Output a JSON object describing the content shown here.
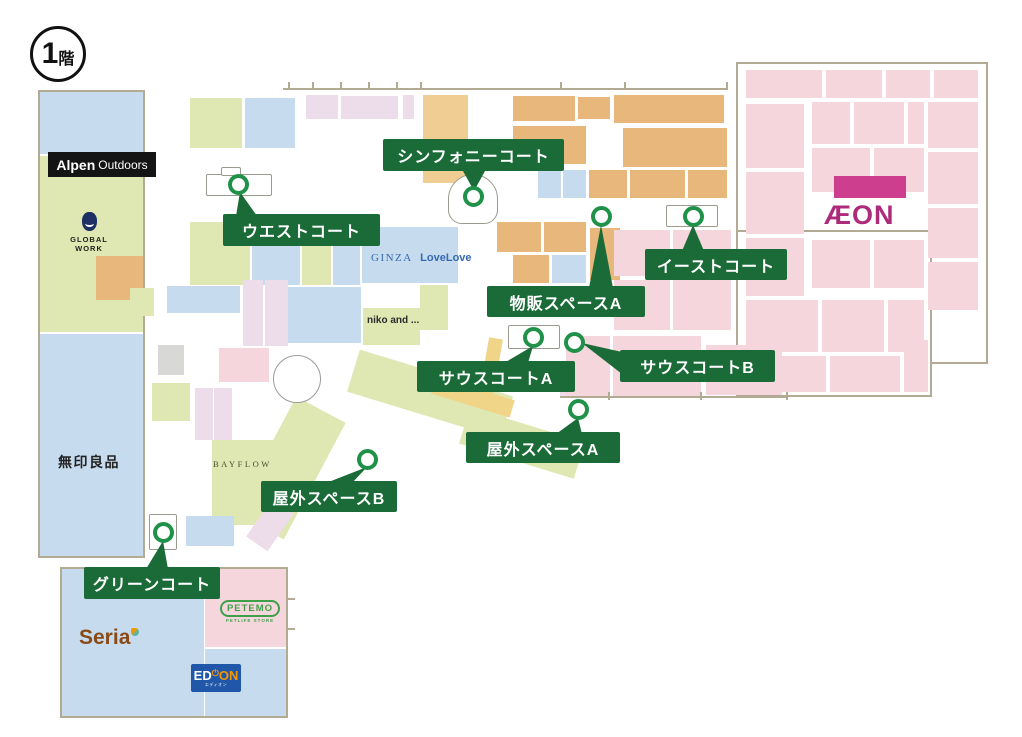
{
  "badge": {
    "number": "1",
    "suffix": "階"
  },
  "palette": {
    "label_green": "#1a6b38",
    "ring_green": "#1f9148",
    "wall": "#b3aa93",
    "block_blue": "#c6dcee",
    "block_green": "#dfe8b2",
    "block_tan": "#f0cd92",
    "block_orange": "#e8b77c",
    "block_pink": "#f5d6dc",
    "block_lavender": "#eddcea",
    "block_gray": "#d8d8d6",
    "block_yellow": "#f0d488",
    "magenta": "#ce3e8e",
    "aeon_text_color": "#ad2b7b",
    "edion_blue": "#2157a8",
    "edion_orange": "#f39800",
    "seria_brown": "#8a4a15",
    "petemo_green": "#3fa04a",
    "ginza_blue": "#3668b2"
  },
  "stores": {
    "alpen_bold": "Alpen",
    "alpen_light": "Outdoors",
    "global_work": "GLOBAL WORK",
    "muji": "無印良品",
    "ginza_serif": "GINZA",
    "ginza_bold": "LoveLove",
    "niko": "niko and ...",
    "bayflow": "BAYFLOW",
    "seria": "Seria",
    "petemo": "PETEMO",
    "petemo_sub": "PETLIFE STORE",
    "edion_ed": "ED",
    "edion_on": "ON",
    "edion_pw": "⏻",
    "edion_sub": "エディオン",
    "aeon": "ÆON"
  },
  "callouts": [
    {
      "id": "symphony-court",
      "label": "シンフォニーコート",
      "box": [
        383,
        139,
        181,
        32
      ],
      "circle": [
        473,
        196
      ],
      "pointer": [
        [
          463,
          171
        ],
        [
          485,
          171
        ],
        [
          474,
          191
        ]
      ]
    },
    {
      "id": "west-court",
      "label": "ウエストコート",
      "box": [
        223,
        214,
        157,
        32
      ],
      "circle": [
        238,
        184
      ],
      "pointer": [
        [
          236,
          216
        ],
        [
          257,
          216
        ],
        [
          240,
          192
        ]
      ]
    },
    {
      "id": "east-court",
      "label": "イーストコート",
      "box": [
        645,
        249,
        142,
        31
      ],
      "circle": [
        693,
        216
      ],
      "pointer": [
        [
          682,
          251
        ],
        [
          704,
          251
        ],
        [
          693,
          225
        ]
      ]
    },
    {
      "id": "retail-space-a",
      "label": "物販スペースA",
      "box": [
        487,
        286,
        158,
        31
      ],
      "circle": [
        601,
        216
      ],
      "pointer": [
        [
          589,
          288
        ],
        [
          613,
          288
        ],
        [
          601,
          225
        ]
      ]
    },
    {
      "id": "south-court-a",
      "label": "サウスコートA",
      "box": [
        417,
        361,
        158,
        31
      ],
      "circle": [
        533,
        337
      ],
      "pointer": [
        [
          504,
          363
        ],
        [
          528,
          363
        ],
        [
          533,
          346
        ]
      ]
    },
    {
      "id": "south-court-b",
      "label": "サウスコートB",
      "box": [
        620,
        350,
        155,
        32
      ],
      "circle": [
        574,
        342
      ],
      "pointer": [
        [
          622,
          352
        ],
        [
          622,
          374
        ],
        [
          582,
          343
        ]
      ]
    },
    {
      "id": "outdoor-space-a",
      "label": "屋外スペースA",
      "box": [
        466,
        432,
        154,
        31
      ],
      "circle": [
        578,
        409
      ],
      "pointer": [
        [
          556,
          434
        ],
        [
          582,
          434
        ],
        [
          578,
          418
        ]
      ]
    },
    {
      "id": "outdoor-space-b",
      "label": "屋外スペースB",
      "box": [
        261,
        481,
        136,
        31
      ],
      "circle": [
        367,
        459
      ],
      "pointer": [
        [
          326,
          483
        ],
        [
          352,
          483
        ],
        [
          367,
          467
        ]
      ]
    },
    {
      "id": "green-court",
      "label": "グリーンコート",
      "box": [
        84,
        567,
        136,
        32
      ],
      "circle": [
        163,
        532
      ],
      "pointer": [
        [
          146,
          569
        ],
        [
          168,
          569
        ],
        [
          163,
          541
        ]
      ]
    }
  ],
  "map": {
    "buildings": [
      [
        38,
        90,
        107,
        468
      ],
      [
        60,
        567,
        228,
        151
      ],
      [
        736,
        62,
        252,
        302
      ],
      [
        736,
        230,
        196,
        167
      ]
    ],
    "roundabout": {
      "cx": 296,
      "cy": 378,
      "r": 23
    },
    "stages": [
      {
        "x": 448,
        "y": 174,
        "w": 50,
        "h": 50,
        "r": "25px 25px 14px 14px"
      },
      {
        "x": 206,
        "y": 174,
        "w": 66,
        "h": 22,
        "r": "2px"
      },
      {
        "x": 221,
        "y": 167,
        "w": 20,
        "h": 9,
        "r": "2px"
      },
      {
        "x": 666,
        "y": 205,
        "w": 52,
        "h": 22,
        "r": "2px"
      },
      {
        "x": 508,
        "y": 325,
        "w": 52,
        "h": 24,
        "r": "2px"
      },
      {
        "x": 149,
        "y": 514,
        "w": 28,
        "h": 36,
        "r": "2px"
      }
    ],
    "blocks": [
      [
        40,
        92,
        103,
        62,
        "blu"
      ],
      [
        40,
        156,
        103,
        176,
        "grn"
      ],
      [
        96,
        256,
        47,
        44,
        "org"
      ],
      [
        40,
        334,
        103,
        222,
        "blu"
      ],
      [
        306,
        95,
        32,
        24,
        "lav"
      ],
      [
        341,
        96,
        57,
        23,
        "lav"
      ],
      [
        403,
        95,
        11,
        24,
        "lav"
      ],
      [
        423,
        95,
        45,
        88,
        "tan"
      ],
      [
        513,
        96,
        62,
        25,
        "org"
      ],
      [
        578,
        97,
        32,
        22,
        "org"
      ],
      [
        614,
        95,
        110,
        28,
        "org"
      ],
      [
        513,
        126,
        73,
        38,
        "org"
      ],
      [
        623,
        128,
        104,
        39,
        "org"
      ],
      [
        538,
        170,
        23,
        28,
        "blu"
      ],
      [
        563,
        170,
        23,
        28,
        "blu"
      ],
      [
        589,
        170,
        38,
        28,
        "org"
      ],
      [
        630,
        170,
        55,
        28,
        "org"
      ],
      [
        688,
        170,
        39,
        28,
        "org"
      ],
      [
        497,
        222,
        44,
        30,
        "org"
      ],
      [
        544,
        222,
        42,
        30,
        "org"
      ],
      [
        513,
        255,
        36,
        28,
        "org"
      ],
      [
        552,
        255,
        34,
        28,
        "blu"
      ],
      [
        590,
        228,
        30,
        52,
        "org"
      ],
      [
        190,
        98,
        52,
        50,
        "grn"
      ],
      [
        245,
        98,
        50,
        50,
        "blu"
      ],
      [
        190,
        222,
        60,
        63,
        "grn"
      ],
      [
        252,
        222,
        48,
        63,
        "blu"
      ],
      [
        302,
        222,
        29,
        63,
        "grn"
      ],
      [
        333,
        240,
        27,
        45,
        "blu"
      ],
      [
        362,
        227,
        96,
        56,
        "blu"
      ],
      [
        130,
        288,
        24,
        28,
        "grn"
      ],
      [
        167,
        286,
        73,
        27,
        "blu"
      ],
      [
        243,
        280,
        20,
        66,
        "lav"
      ],
      [
        265,
        280,
        23,
        66,
        "lav"
      ],
      [
        288,
        287,
        73,
        56,
        "blu"
      ],
      [
        363,
        308,
        57,
        37,
        "grn"
      ],
      [
        420,
        285,
        28,
        45,
        "grn"
      ],
      [
        158,
        345,
        26,
        30,
        "gry"
      ],
      [
        219,
        348,
        50,
        34,
        "pnk"
      ],
      [
        152,
        383,
        38,
        38,
        "grn"
      ],
      [
        195,
        388,
        18,
        52,
        "lav"
      ],
      [
        214,
        388,
        18,
        52,
        "lav"
      ],
      [
        212,
        440,
        73,
        85,
        "grn"
      ],
      [
        186,
        516,
        48,
        30,
        "blu"
      ],
      [
        350,
        372,
        160,
        44,
        "grn",
        17
      ],
      [
        462,
        424,
        120,
        38,
        "grn",
        17
      ],
      [
        262,
        402,
        56,
        132,
        "grn",
        28
      ],
      [
        484,
        338,
        14,
        58,
        "yel",
        10
      ],
      [
        432,
        388,
        82,
        18,
        "yel",
        17
      ],
      [
        560,
        368,
        26,
        30,
        "lav"
      ],
      [
        247,
        512,
        46,
        26,
        "lav",
        -55
      ],
      [
        566,
        336,
        44,
        60,
        "pnk"
      ],
      [
        613,
        336,
        88,
        60,
        "pnk"
      ],
      [
        706,
        345,
        76,
        50,
        "pnk"
      ],
      [
        614,
        230,
        56,
        46,
        "pnk"
      ],
      [
        673,
        230,
        58,
        46,
        "pnk"
      ],
      [
        614,
        280,
        56,
        50,
        "pnk"
      ],
      [
        673,
        280,
        58,
        50,
        "pnk"
      ],
      [
        715,
        230,
        16,
        100,
        "pnk"
      ],
      [
        62,
        569,
        142,
        147,
        "blu"
      ],
      [
        205,
        569,
        81,
        78,
        "pnk"
      ],
      [
        205,
        649,
        81,
        67,
        "blu"
      ],
      [
        746,
        70,
        76,
        28,
        "pnk"
      ],
      [
        826,
        70,
        56,
        28,
        "pnk"
      ],
      [
        886,
        70,
        44,
        28,
        "pnk"
      ],
      [
        934,
        70,
        44,
        28,
        "pnk"
      ],
      [
        746,
        104,
        58,
        64,
        "pnk"
      ],
      [
        746,
        172,
        58,
        62,
        "pnk"
      ],
      [
        746,
        238,
        58,
        58,
        "pnk"
      ],
      [
        812,
        102,
        38,
        42,
        "pnk"
      ],
      [
        854,
        102,
        50,
        42,
        "pnk"
      ],
      [
        908,
        102,
        16,
        42,
        "pnk"
      ],
      [
        812,
        148,
        58,
        44,
        "pnk"
      ],
      [
        874,
        148,
        50,
        44,
        "pnk"
      ],
      [
        928,
        102,
        50,
        46,
        "pnk"
      ],
      [
        928,
        152,
        50,
        52,
        "pnk"
      ],
      [
        928,
        208,
        50,
        50,
        "pnk"
      ],
      [
        928,
        262,
        50,
        48,
        "pnk"
      ],
      [
        812,
        240,
        58,
        48,
        "pnk"
      ],
      [
        874,
        240,
        50,
        48,
        "pnk"
      ],
      [
        746,
        300,
        72,
        52,
        "pnk"
      ],
      [
        822,
        300,
        62,
        52,
        "pnk"
      ],
      [
        888,
        300,
        36,
        52,
        "pnk"
      ],
      [
        746,
        356,
        80,
        36,
        "pnk"
      ],
      [
        830,
        356,
        70,
        36,
        "pnk"
      ],
      [
        904,
        340,
        24,
        52,
        "pnk"
      ],
      [
        834,
        176,
        72,
        22,
        "mag"
      ]
    ],
    "walls": [
      [
        283,
        88,
        444,
        2
      ],
      [
        560,
        396,
        228,
        2
      ],
      [
        288,
        82,
        2,
        8
      ],
      [
        312,
        82,
        2,
        8
      ],
      [
        340,
        82,
        2,
        8
      ],
      [
        368,
        82,
        2,
        8
      ],
      [
        396,
        82,
        2,
        8
      ],
      [
        420,
        82,
        2,
        8
      ],
      [
        560,
        82,
        2,
        8
      ],
      [
        624,
        82,
        2,
        8
      ],
      [
        726,
        82,
        2,
        8
      ],
      [
        608,
        392,
        2,
        8
      ],
      [
        700,
        392,
        2,
        8
      ],
      [
        786,
        392,
        2,
        8
      ],
      [
        287,
        598,
        8,
        2
      ],
      [
        287,
        628,
        8,
        2
      ]
    ]
  }
}
